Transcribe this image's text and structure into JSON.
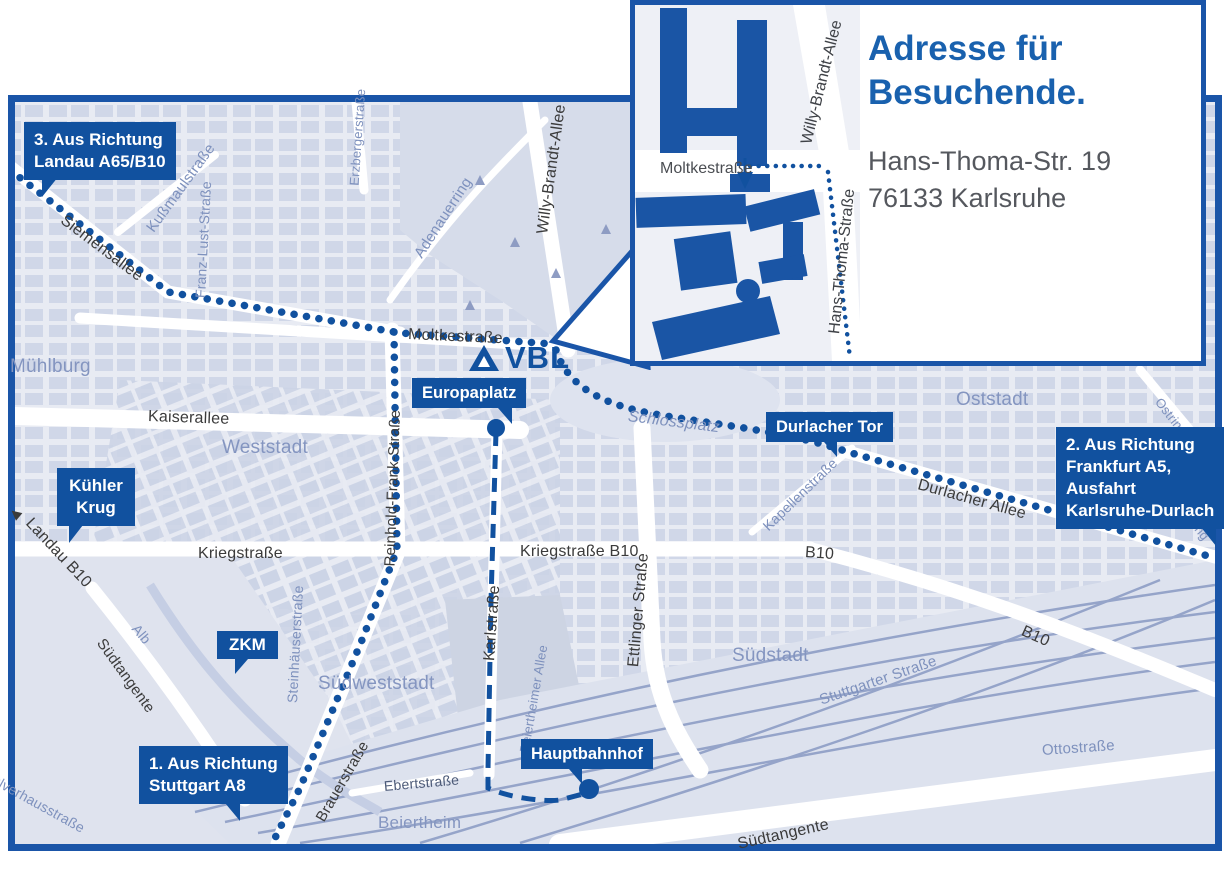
{
  "colors": {
    "accent": "#11519f",
    "map_border": "#1a55a8",
    "district_text": "#8495c0",
    "street_text": "#3b3b3b",
    "blue_street_text": "#7e91bd",
    "inset_heading": "#1961ae"
  },
  "logo": {
    "label": "VBL"
  },
  "icons": {
    "landau_arrow": "◀"
  },
  "inset": {
    "heading": [
      "Adresse für",
      "Besuchende."
    ],
    "address": [
      "Hans-Thoma-Str. 19",
      "76133 Karlsruhe"
    ],
    "streets": {
      "moltkestrasse": "Moltkestraße",
      "willy_brandt": "Willy-Brandt-Allee",
      "hans_thoma": "Hans-Thoma-Straße"
    }
  },
  "callouts": {
    "landau": {
      "lines": [
        "3. Aus Richtung",
        "Landau A65/B10"
      ]
    },
    "frankfurt": {
      "lines": [
        "2. Aus Richtung",
        "Frankfurt A5,",
        "Ausfahrt",
        "Karlsruhe-Durlach"
      ]
    },
    "stuttgart": {
      "lines": [
        "1. Aus Richtung",
        "Stuttgart A8"
      ]
    },
    "kuehler_krug": {
      "lines": [
        "Kühler",
        "Krug"
      ]
    },
    "zkm": {
      "lines": [
        "ZKM"
      ]
    },
    "europaplatz": {
      "lines": [
        "Europaplatz"
      ]
    },
    "durlacher_tor": {
      "lines": [
        "Durlacher Tor"
      ]
    },
    "hauptbahnhof": {
      "lines": [
        "Hauptbahnhof"
      ]
    }
  },
  "streets": {
    "siemensallee": "Siemensallee",
    "kussmaulstrasse": "Kußmaulstraße",
    "franz_lust": "Franz-Lust-Straße",
    "erzbergerstrasse": "Erzbergerstraße",
    "adenauerring": "Adenauerring",
    "willy_brandt": "Willy-Brandt-Allee",
    "moltkestrasse": "Moltkestraße",
    "kaiserallee": "Kaiserallee",
    "reinhold_frank": "Reinhold-Frank-Straße",
    "kriegstrasse": "Kriegstraße",
    "kriegstrasse_b10": "Kriegstraße B10",
    "karlstrasse": "Karlstraße",
    "ettlinger": "Ettlinger Straße",
    "beiertheimer_allee": "Beiertheimer Allee",
    "durlacher_allee": "Durlacher Allee",
    "kapellenstrasse": "Kapellenstraße",
    "b10_mid": "B10",
    "b10_right": "B10",
    "ostring": "Ostring",
    "ostring2": "Ostring",
    "landau_b10": "Landau B10",
    "brauerstrasse": "Brauerstraße",
    "steinhaeuserstrasse": "Steinhäuserstraße",
    "ebertstrasse": "Ebertstraße",
    "stuttgarter": "Stuttgarter Straße",
    "ottostrasse": "Ottostraße",
    "suedtangente_left": "Südtangente",
    "suedtangente_right": "Südtangente",
    "pulverhausstrasse": "Pulverhausstraße",
    "alb": "Alb"
  },
  "districts": {
    "muehlburg": "Mühlburg",
    "weststadt": "Weststadt",
    "oststadt": "Oststadt",
    "suedstadt": "Südstadt",
    "suedweststadt": "Südweststadt",
    "beiertheim": "Beiertheim",
    "schlossplatz": "Schlossplatz"
  }
}
